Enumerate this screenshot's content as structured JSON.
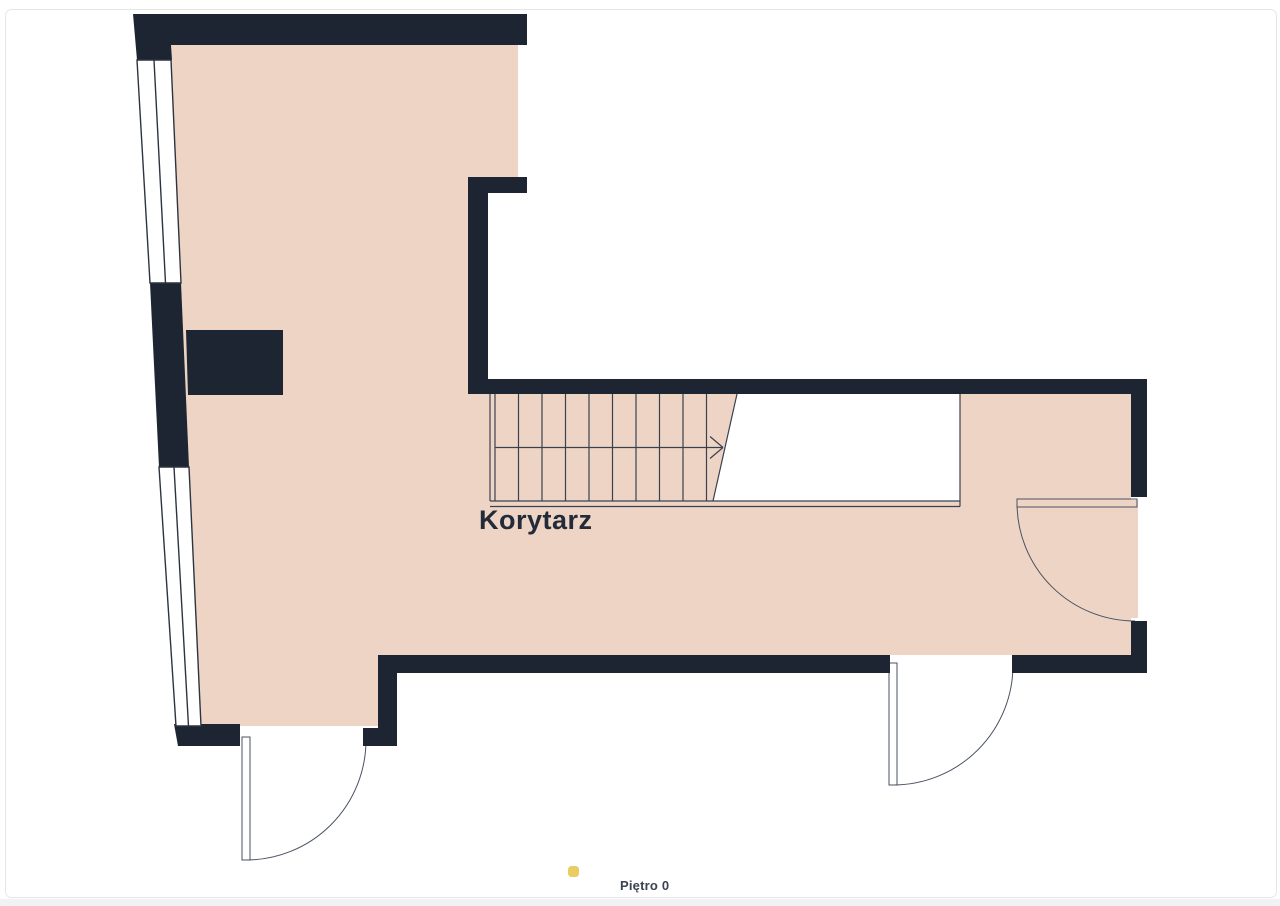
{
  "floorplan": {
    "rooms": [
      {
        "label": "Korytarz"
      }
    ],
    "stairs": {
      "visible_steps": 11,
      "direction_arrow": "right"
    },
    "doors": 3,
    "windows": 2,
    "colors": {
      "wall": "#1d2532",
      "floor": "#eed4c5",
      "line": "#39414f",
      "window_fill": "#ffffff",
      "void_fill": "#ffffff",
      "background": "#ffffff",
      "card_border": "#e4e6e8",
      "footer_strip": "#f1f2f3",
      "marker": "#e9cc62",
      "label_text": "#232b39",
      "footer_text": "#3b4250"
    }
  },
  "footer": {
    "floor_label": "Piętro 0"
  }
}
